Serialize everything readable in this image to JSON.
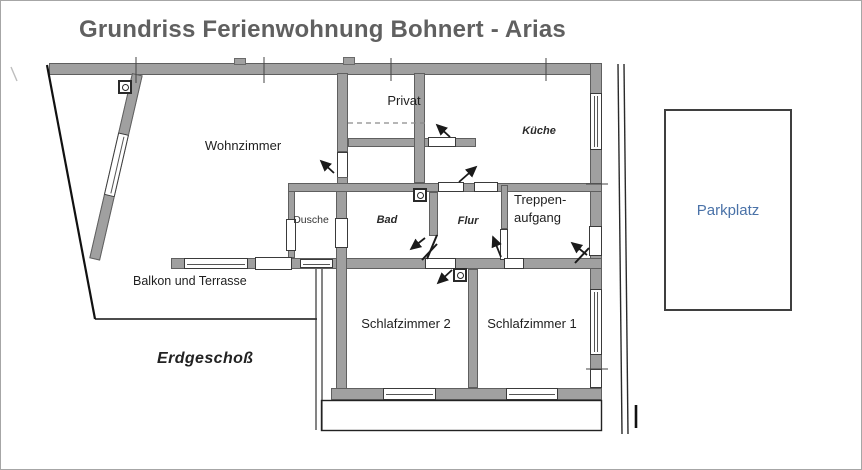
{
  "title": "Grundriss Ferienwohnung Bohnert - Arias",
  "floor_label": "Erdgeschoß",
  "outdoor": {
    "balcony_label": "Balkon und Terrasse"
  },
  "rooms": [
    {
      "id": "wohnzimmer",
      "label": "Wohnzimmer"
    },
    {
      "id": "privat",
      "label": "Privat"
    },
    {
      "id": "kueche",
      "label": "Küche"
    },
    {
      "id": "dusche",
      "label": "Dusche"
    },
    {
      "id": "bad",
      "label": "Bad"
    },
    {
      "id": "flur",
      "label": "Flur"
    },
    {
      "id": "treppenaufgang",
      "label_lines": [
        "Treppen-",
        "aufgang"
      ]
    },
    {
      "id": "schlafzimmer2",
      "label": "Schlafzimmer 2"
    },
    {
      "id": "schlafzimmer1",
      "label": "Schlafzimmer 1"
    }
  ],
  "parking": {
    "label": "Parkplatz",
    "text_color": "#4a72a8"
  },
  "icons": {
    "outlet": "circle-in-square symbol",
    "door_arrow": "small diagonal arrow marking door openings"
  },
  "colors": {
    "wall_fill": "#a0a0a0",
    "wall_edge": "#5f5f5f",
    "title_text": "#606060",
    "line_ink": "#1a1a1a"
  }
}
